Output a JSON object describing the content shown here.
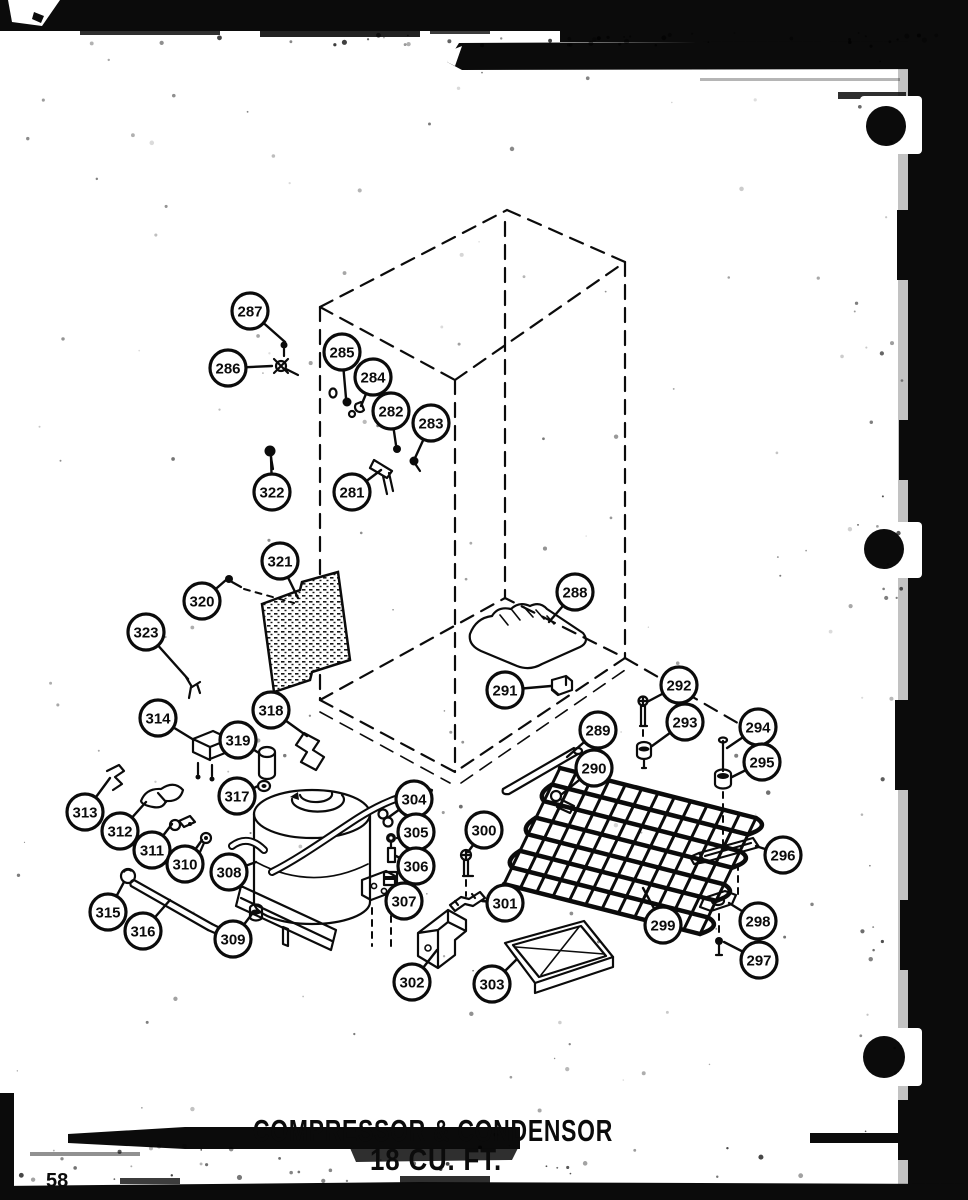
{
  "page": {
    "number": "58"
  },
  "title": {
    "line1": "COMPRESSOR & CONDENSOR",
    "line2": "18 CU. FT."
  },
  "diagram": {
    "type": "exploded-parts-diagram",
    "callouts": [
      {
        "label": "287",
        "cx": 250,
        "cy": 311,
        "tx": 285,
        "ty": 342
      },
      {
        "label": "286",
        "cx": 228,
        "cy": 368,
        "tx": 272,
        "ty": 366
      },
      {
        "label": "285",
        "cx": 342,
        "cy": 352,
        "tx": 346,
        "ty": 398
      },
      {
        "label": "284",
        "cx": 373,
        "cy": 377,
        "tx": 361,
        "ty": 406
      },
      {
        "label": "282",
        "cx": 391,
        "cy": 411,
        "tx": 396,
        "ty": 445
      },
      {
        "label": "283",
        "cx": 431,
        "cy": 423,
        "tx": 415,
        "ty": 458
      },
      {
        "label": "281",
        "cx": 352,
        "cy": 492,
        "tx": 381,
        "ty": 470
      },
      {
        "label": "322",
        "cx": 272,
        "cy": 492,
        "tx": 271,
        "ty": 456
      },
      {
        "label": "321",
        "cx": 280,
        "cy": 561,
        "tx": 298,
        "ty": 598
      },
      {
        "label": "320",
        "cx": 202,
        "cy": 601,
        "tx": 226,
        "ty": 580
      },
      {
        "label": "323",
        "cx": 146,
        "cy": 632,
        "tx": 188,
        "ty": 679
      },
      {
        "label": "318",
        "cx": 271,
        "cy": 710,
        "tx": 307,
        "ty": 736
      },
      {
        "label": "319",
        "cx": 238,
        "cy": 740,
        "tx": 259,
        "ty": 753
      },
      {
        "label": "317",
        "cx": 237,
        "cy": 796,
        "tx": 258,
        "ty": 786
      },
      {
        "label": "314",
        "cx": 158,
        "cy": 718,
        "tx": 194,
        "ty": 740
      },
      {
        "label": "313",
        "cx": 85,
        "cy": 812,
        "tx": 110,
        "ty": 778
      },
      {
        "label": "312",
        "cx": 120,
        "cy": 831,
        "tx": 146,
        "ty": 802
      },
      {
        "label": "311",
        "cx": 152,
        "cy": 850,
        "tx": 172,
        "ty": 824
      },
      {
        "label": "310",
        "cx": 185,
        "cy": 864,
        "tx": 202,
        "ty": 840
      },
      {
        "label": "308",
        "cx": 229,
        "cy": 872,
        "tx": 256,
        "ty": 862
      },
      {
        "label": "315",
        "cx": 108,
        "cy": 912,
        "tx": 124,
        "ty": 882
      },
      {
        "label": "316",
        "cx": 143,
        "cy": 931,
        "tx": 170,
        "ty": 900
      },
      {
        "label": "309",
        "cx": 233,
        "cy": 939,
        "tx": 252,
        "ty": 914
      },
      {
        "label": "304",
        "cx": 414,
        "cy": 799,
        "tx": 389,
        "ty": 817
      },
      {
        "label": "305",
        "cx": 416,
        "cy": 832,
        "tx": 397,
        "ty": 838
      },
      {
        "label": "306",
        "cx": 416,
        "cy": 866,
        "tx": 396,
        "ty": 856
      },
      {
        "label": "307",
        "cx": 404,
        "cy": 901,
        "tx": 396,
        "ty": 880
      },
      {
        "label": "300",
        "cx": 484,
        "cy": 830,
        "tx": 468,
        "ty": 852
      },
      {
        "label": "301",
        "cx": 505,
        "cy": 903,
        "tx": 482,
        "ty": 901
      },
      {
        "label": "302",
        "cx": 412,
        "cy": 982,
        "tx": 437,
        "ty": 950
      },
      {
        "label": "303",
        "cx": 492,
        "cy": 984,
        "tx": 516,
        "ty": 960
      },
      {
        "label": "288",
        "cx": 575,
        "cy": 592,
        "tx": 549,
        "ty": 622
      },
      {
        "label": "291",
        "cx": 505,
        "cy": 690,
        "tx": 551,
        "ty": 686
      },
      {
        "label": "289",
        "cx": 598,
        "cy": 730,
        "tx": 567,
        "ty": 757
      },
      {
        "label": "290",
        "cx": 594,
        "cy": 768,
        "tx": 562,
        "ty": 794
      },
      {
        "label": "292",
        "cx": 679,
        "cy": 685,
        "tx": 647,
        "ty": 702
      },
      {
        "label": "293",
        "cx": 685,
        "cy": 722,
        "tx": 652,
        "ty": 746
      },
      {
        "label": "294",
        "cx": 758,
        "cy": 727,
        "tx": 727,
        "ty": 748
      },
      {
        "label": "295",
        "cx": 762,
        "cy": 762,
        "tx": 732,
        "ty": 777
      },
      {
        "label": "296",
        "cx": 783,
        "cy": 855,
        "tx": 756,
        "ty": 846
      },
      {
        "label": "299",
        "cx": 663,
        "cy": 925,
        "tx": 643,
        "ty": 888
      },
      {
        "label": "298",
        "cx": 758,
        "cy": 921,
        "tx": 729,
        "ty": 903
      },
      {
        "label": "297",
        "cx": 759,
        "cy": 960,
        "tx": 724,
        "ty": 942
      }
    ]
  }
}
